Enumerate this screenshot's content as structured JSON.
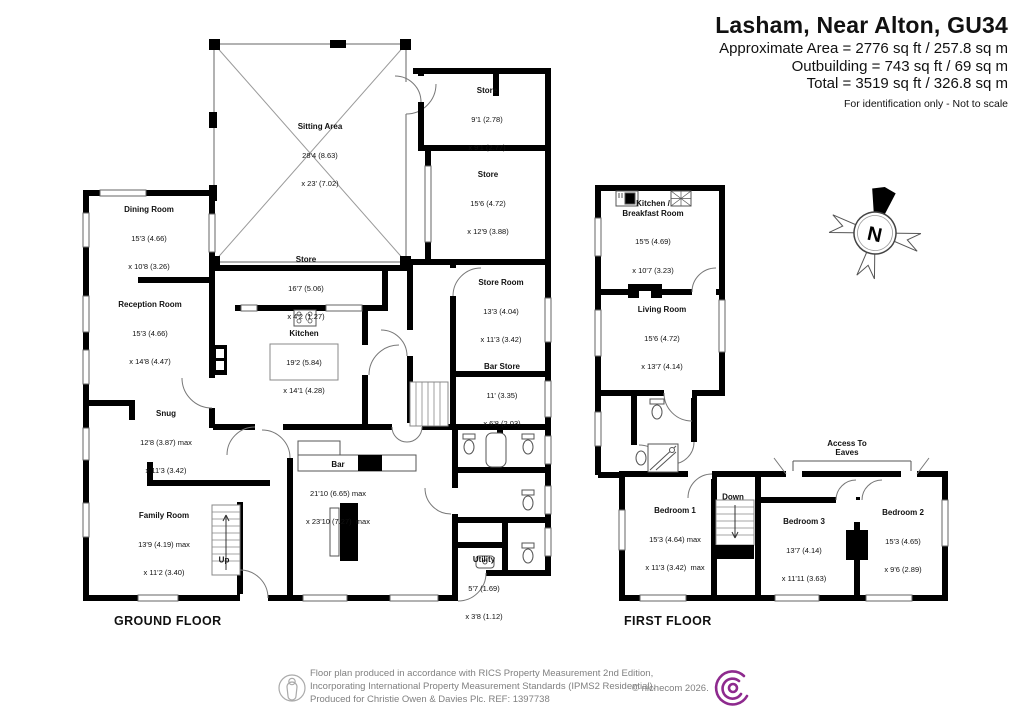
{
  "header": {
    "title": "Lasham, Near Alton, GU34",
    "area_line1": "Approximate Area = 2776 sq ft / 257.8 sq m",
    "area_line2": "Outbuilding = 743 sq ft / 69 sq m",
    "area_line3": "Total = 3519 sq ft / 326.8 sq m",
    "note": "For identification only - Not to scale"
  },
  "ground": {
    "label": "GROUND FLOOR",
    "up_label": "Up",
    "rooms": [
      {
        "name": "Sitting Area",
        "dims1": "28'4 (8.63)",
        "dims2": "x 23' (7.02)"
      },
      {
        "name": "Store",
        "dims1": "9'1 (2.78)",
        "dims2": "x 9'1 (2.77)"
      },
      {
        "name": "Store",
        "dims1": "15'6 (4.72)",
        "dims2": "x 12'9 (3.88)"
      },
      {
        "name": "Store",
        "dims1": "16'7 (5.06)",
        "dims2": "x 4'2 (1.27)"
      },
      {
        "name": "Store Room",
        "dims1": "13'3 (4.04)",
        "dims2": "x 11'3 (3.42)"
      },
      {
        "name": "Bar Store",
        "dims1": "11' (3.35)",
        "dims2": "x 6'8 (2.03)"
      },
      {
        "name": "Dining Room",
        "dims1": "15'3 (4.66)",
        "dims2": "x 10'8 (3.26)"
      },
      {
        "name": "Reception Room",
        "dims1": "15'3 (4.66)",
        "dims2": "x 14'8 (4.47)"
      },
      {
        "name": "Kitchen",
        "dims1": "19'2 (5.84)",
        "dims2": "x 14'1 (4.28)"
      },
      {
        "name": "Snug",
        "dims1": "12'8 (3.87) max",
        "dims2": "x 11'3 (3.42)"
      },
      {
        "name": "Family Room",
        "dims1": "13'9 (4.19) max",
        "dims2": "x 11'2 (3.40)"
      },
      {
        "name": "Bar",
        "dims1": "21'10 (6.65) max",
        "dims2": "x 23'10 (7.27)  max"
      },
      {
        "name": "Utility",
        "dims1": "5'7 (1.69)",
        "dims2": "x 3'8 (1.12)"
      }
    ]
  },
  "first": {
    "label": "FIRST FLOOR",
    "down_label": "Down",
    "eaves_label": "Access To\nEaves",
    "rooms": [
      {
        "name": "Kitchen /\nBreakfast Room",
        "dims1": "15'5 (4.69)",
        "dims2": "x 10'7 (3.23)"
      },
      {
        "name": "Living Room",
        "dims1": "15'6 (4.72)",
        "dims2": "x 13'7 (4.14)"
      },
      {
        "name": "Bedroom 1",
        "dims1": "15'3 (4.64) max",
        "dims2": "x 11'3 (3.42)  max"
      },
      {
        "name": "Bedroom 3",
        "dims1": "13'7 (4.14)",
        "dims2": "x 11'11 (3.63)"
      },
      {
        "name": "Bedroom 2",
        "dims1": "15'3 (4.65)",
        "dims2": "x 9'6 (2.89)"
      }
    ]
  },
  "compass": {
    "north_label": "N"
  },
  "footer": {
    "line1": "Floor plan produced in accordance with RICS Property Measurement 2nd Edition,",
    "line2": "Incorporating International Property Measurement Standards (IPMS2 Residential).",
    "line3": "Produced for Christie Owen & Davies Plc.    REF: 1397738",
    "copyright": "© nichecom 2026."
  },
  "colors": {
    "logo_magenta": "#8e2a8e",
    "wall_black": "#000000"
  }
}
